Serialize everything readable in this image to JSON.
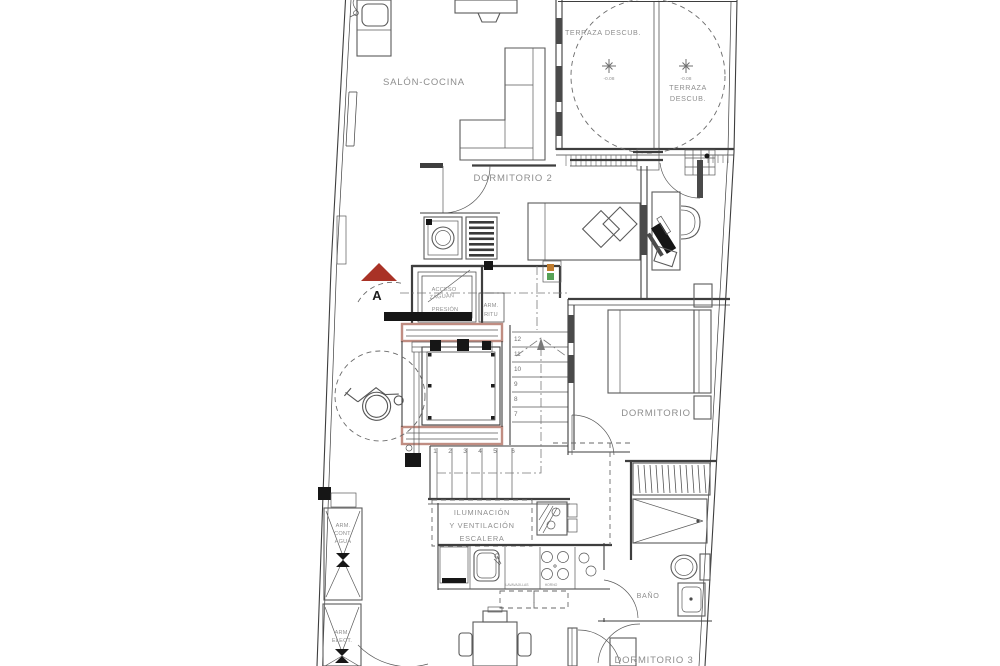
{
  "colors": {
    "line": "#3e3e3e",
    "label_gray": "#8e8e8e",
    "section_marker_red": "#a93226",
    "elevator_accent": "#c08d82",
    "signal_orange": "#c07c2e",
    "signal_green": "#56a156",
    "background": "#ffffff"
  },
  "rooms": {
    "salon_cocina": "SALÓN-COCINA",
    "terraza_main": "TERRAZA DESCUB.",
    "terraza_small_l1": "TERRAZA",
    "terraza_small_l2": "DESCUB.",
    "dormitorio2": "DORMITORIO 2",
    "dormitorio": "DORMITORIO",
    "dormitorio3": "DORMITORIO 3",
    "bano": "BAÑO"
  },
  "annotations": {
    "escalera_l1": "ILUMINACIÓN",
    "escalera_l2": "Y VENTILACIÓN",
    "escalera_l3": "ESCALERA",
    "arm_cont_l1": "ARM.",
    "arm_cont_l2": "CONT.",
    "arm_cont_l3": "AGUA",
    "arm_elect_l1": "ARM.",
    "arm_elect_l2": "ELECT.",
    "arm_ritu_l1": "ARM.",
    "arm_ritu_l2": "RITU",
    "acceso_l1": "ACCESO",
    "acceso_l2": "ZAGUAN",
    "acceso_l3": "PRESIÓN",
    "lavavajillas": "LAVAVAJILLAS",
    "horno": "HORNO",
    "section_marker": "A",
    "elevation_1": "-0.08",
    "elevation_2": "-0.08"
  },
  "stairs": {
    "upper": [
      "12",
      "11",
      "10",
      "9",
      "8",
      "7"
    ],
    "lower": [
      "1",
      "2",
      "3",
      "4",
      "5",
      "6"
    ]
  }
}
